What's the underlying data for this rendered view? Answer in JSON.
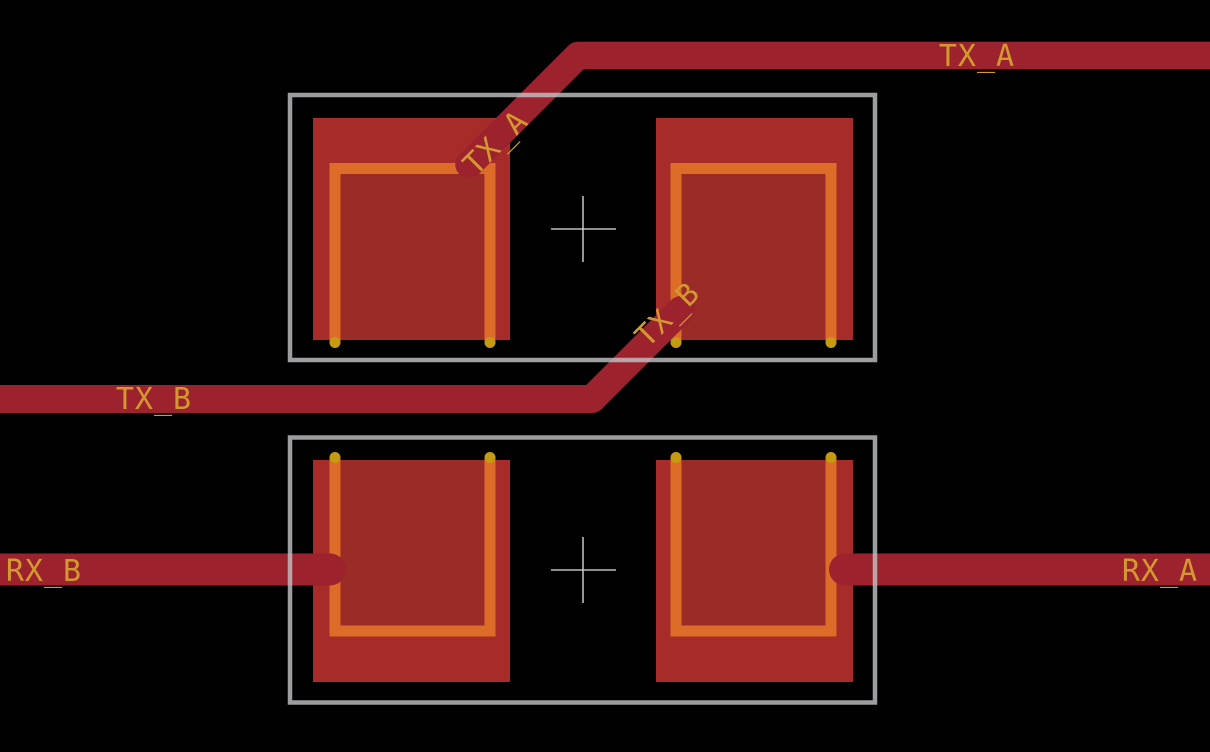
{
  "view": {
    "type": "pcb-layout-canvas",
    "background": "#010101",
    "width": 1210,
    "height": 752
  },
  "colors": {
    "bg": "#010101",
    "trace-red": "#9c232e",
    "pad-red": "#a72b28",
    "pad-inner-red": "#9a2b26",
    "paste-orange": "#dc6c28",
    "dot-gold": "#c49a12",
    "outline-gray": "#c2c4c6",
    "crosshair-gray": "#d0d2d3",
    "label-gold": "#d49831"
  },
  "nets": {
    "tx_a": "TX_A",
    "tx_b": "TX_B",
    "rx_a": "RX_A",
    "rx_b": "RX_B"
  },
  "labels": [
    {
      "text": "TX_A",
      "rotation": 0,
      "placement": "top-right-horizontal-trace"
    },
    {
      "text": "TX_A",
      "rotation": -45,
      "placement": "diagonal-into-top-footprint-pad1"
    },
    {
      "text": "TX_B",
      "rotation": -45,
      "placement": "diagonal-into-top-footprint-pad2"
    },
    {
      "text": "TX_B",
      "rotation": 0,
      "placement": "left-horizontal-trace"
    },
    {
      "text": "RX_B",
      "rotation": 0,
      "placement": "left-horizontal-trace-bottom"
    },
    {
      "text": "RX_A",
      "rotation": 0,
      "placement": "right-horizontal-trace-bottom"
    }
  ],
  "footprints": [
    {
      "id": "footprint-top",
      "pad_count": 2,
      "paste_u_open_side": "bottom",
      "anchor": {
        "x": 583,
        "y": 229
      }
    },
    {
      "id": "footprint-bottom",
      "pad_count": 2,
      "paste_u_open_side": "top",
      "anchor": {
        "x": 583,
        "y": 570
      }
    }
  ],
  "traces": [
    {
      "net": "TX_A",
      "route": "horizontal from right edge, 45-degree bend down-left into top footprint pad 1"
    },
    {
      "net": "TX_B",
      "route": "horizontal from left edge, 45-degree bend up-right into top footprint pad 2"
    },
    {
      "net": "RX_B",
      "route": "horizontal from left edge into bottom footprint pad 1"
    },
    {
      "net": "RX_A",
      "route": "horizontal from bottom footprint pad 2 to right edge"
    }
  ]
}
